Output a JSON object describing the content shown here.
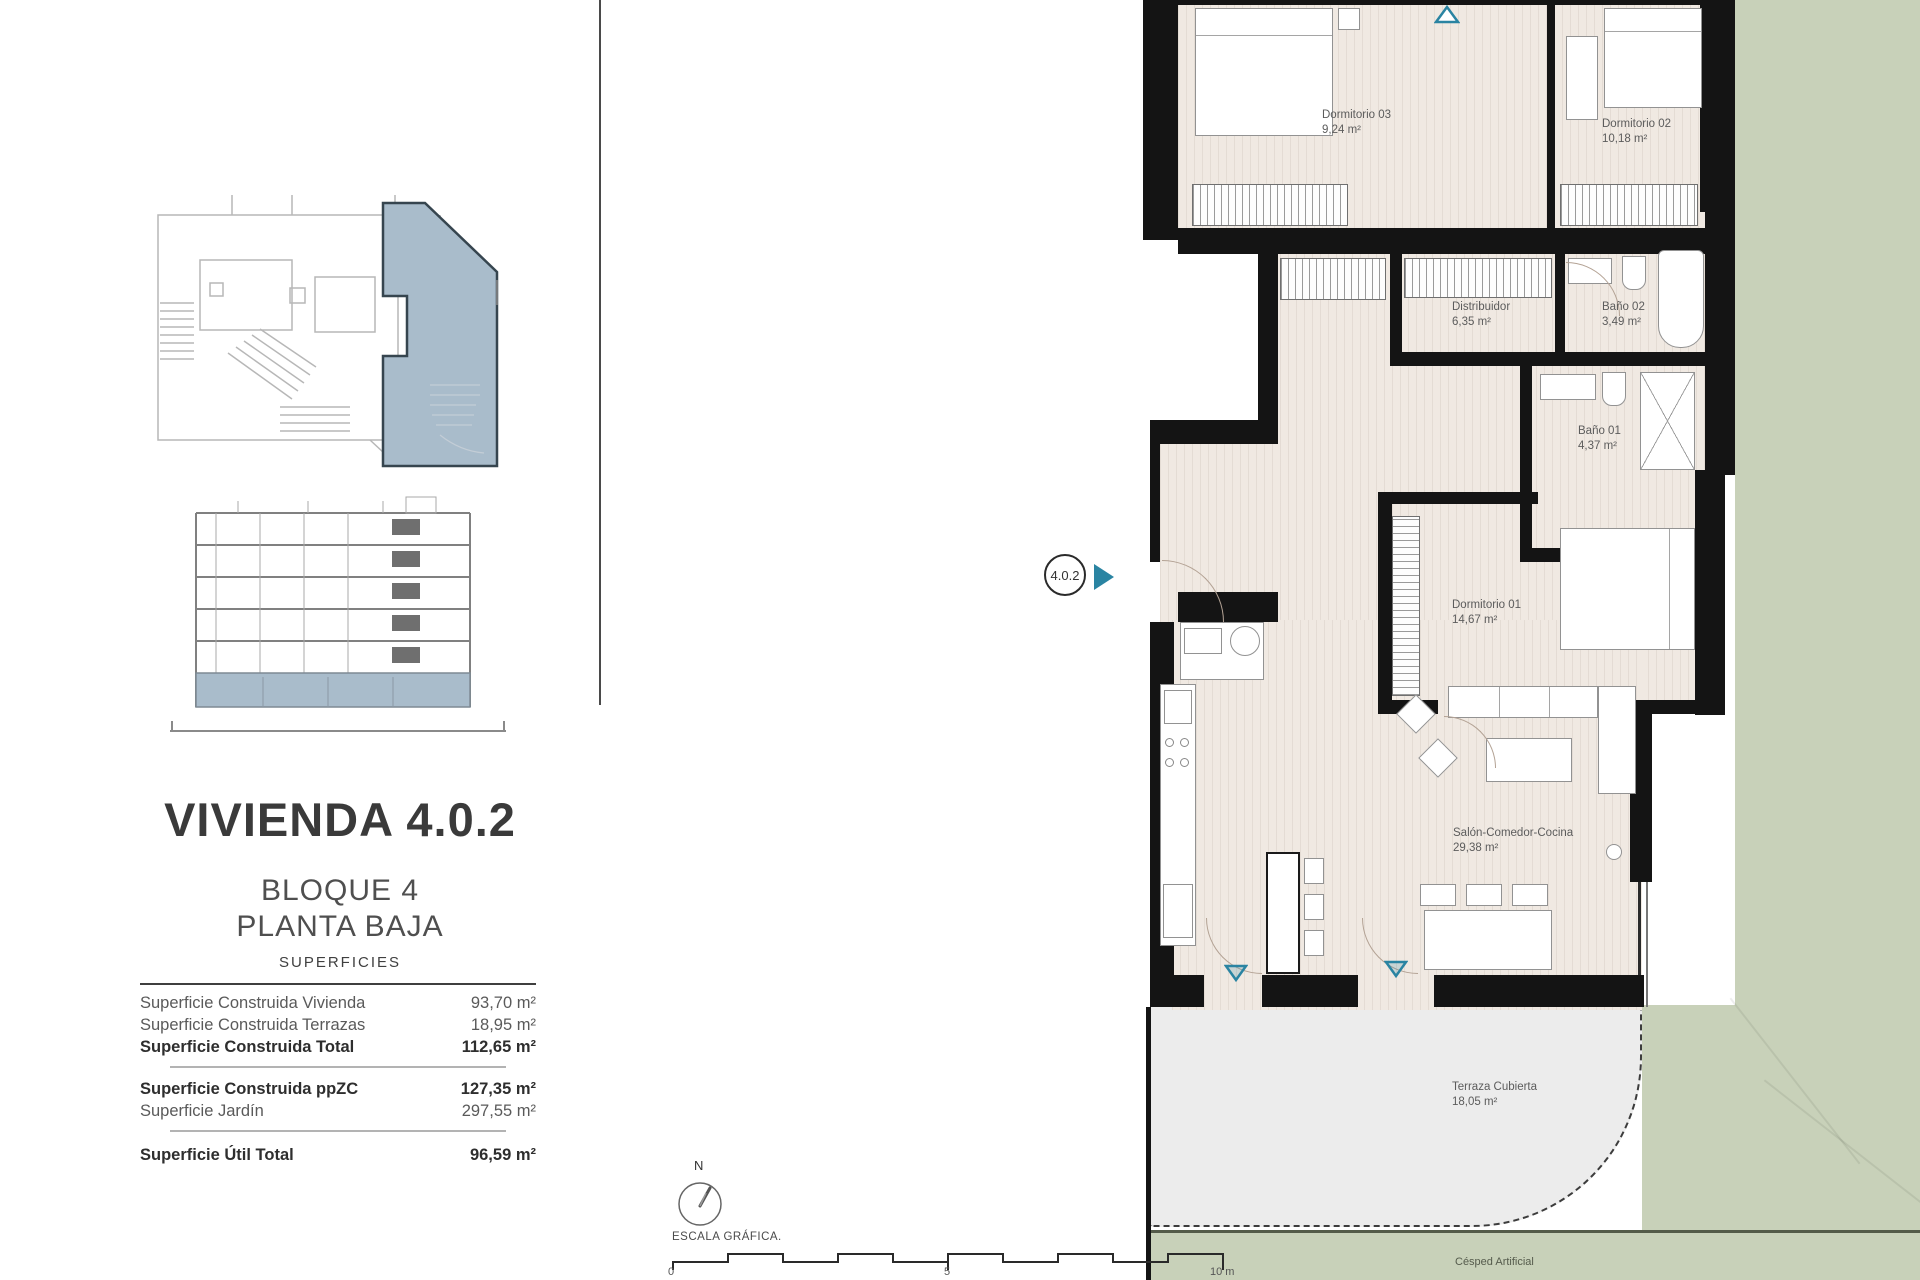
{
  "left_panel": {
    "title": "VIVIENDA 4.0.2",
    "block": "BLOQUE 4",
    "floor": "PLANTA BAJA",
    "surfaces_header": "SUPERFICIES",
    "rows": [
      {
        "label": "Superficie Construida Vivienda",
        "value": "93,70 m²"
      },
      {
        "label": "Superficie Construida Terrazas",
        "value": "18,95 m²"
      },
      {
        "label": "Superficie Construida Total",
        "value": "112,65 m²"
      },
      {
        "label": "Superficie Construida ppZC",
        "value": "127,35 m²"
      },
      {
        "label": "Superficie Jardín",
        "value": "297,55 m²"
      },
      {
        "label": "Superficie Útil Total",
        "value": "96,59 m²"
      }
    ]
  },
  "plan": {
    "unit_marker": "4.0.2",
    "rooms": [
      {
        "name": "Dormitorio 03",
        "area": "9,24 m²"
      },
      {
        "name": "Dormitorio 02",
        "area": "10,18 m²"
      },
      {
        "name": "Distribuidor",
        "area": "6,35 m²"
      },
      {
        "name": "Baño 02",
        "area": "3,49 m²"
      },
      {
        "name": "Baño 01",
        "area": "4,37 m²"
      },
      {
        "name": "Dormitorio 01",
        "area": "14,67 m²"
      },
      {
        "name": "Salón-Comedor-Cocina",
        "area": "29,38 m²"
      },
      {
        "name": "Terraza Cubierta",
        "area": "18,05 m²"
      }
    ],
    "garden_label": "Césped Artificial"
  },
  "footer": {
    "north": "N",
    "scale_title": "ESCALA GRÁFICA.",
    "ticks": [
      "0",
      "5",
      "10 m"
    ]
  },
  "colors": {
    "accent_teal": "#2a84a2",
    "unit_highlight_blue": "#a9bccb",
    "garden_green": "#c8d1b9",
    "floor_beige": "#f0e9e2",
    "terrace_gray": "#ececec",
    "wall_black": "#141414"
  }
}
